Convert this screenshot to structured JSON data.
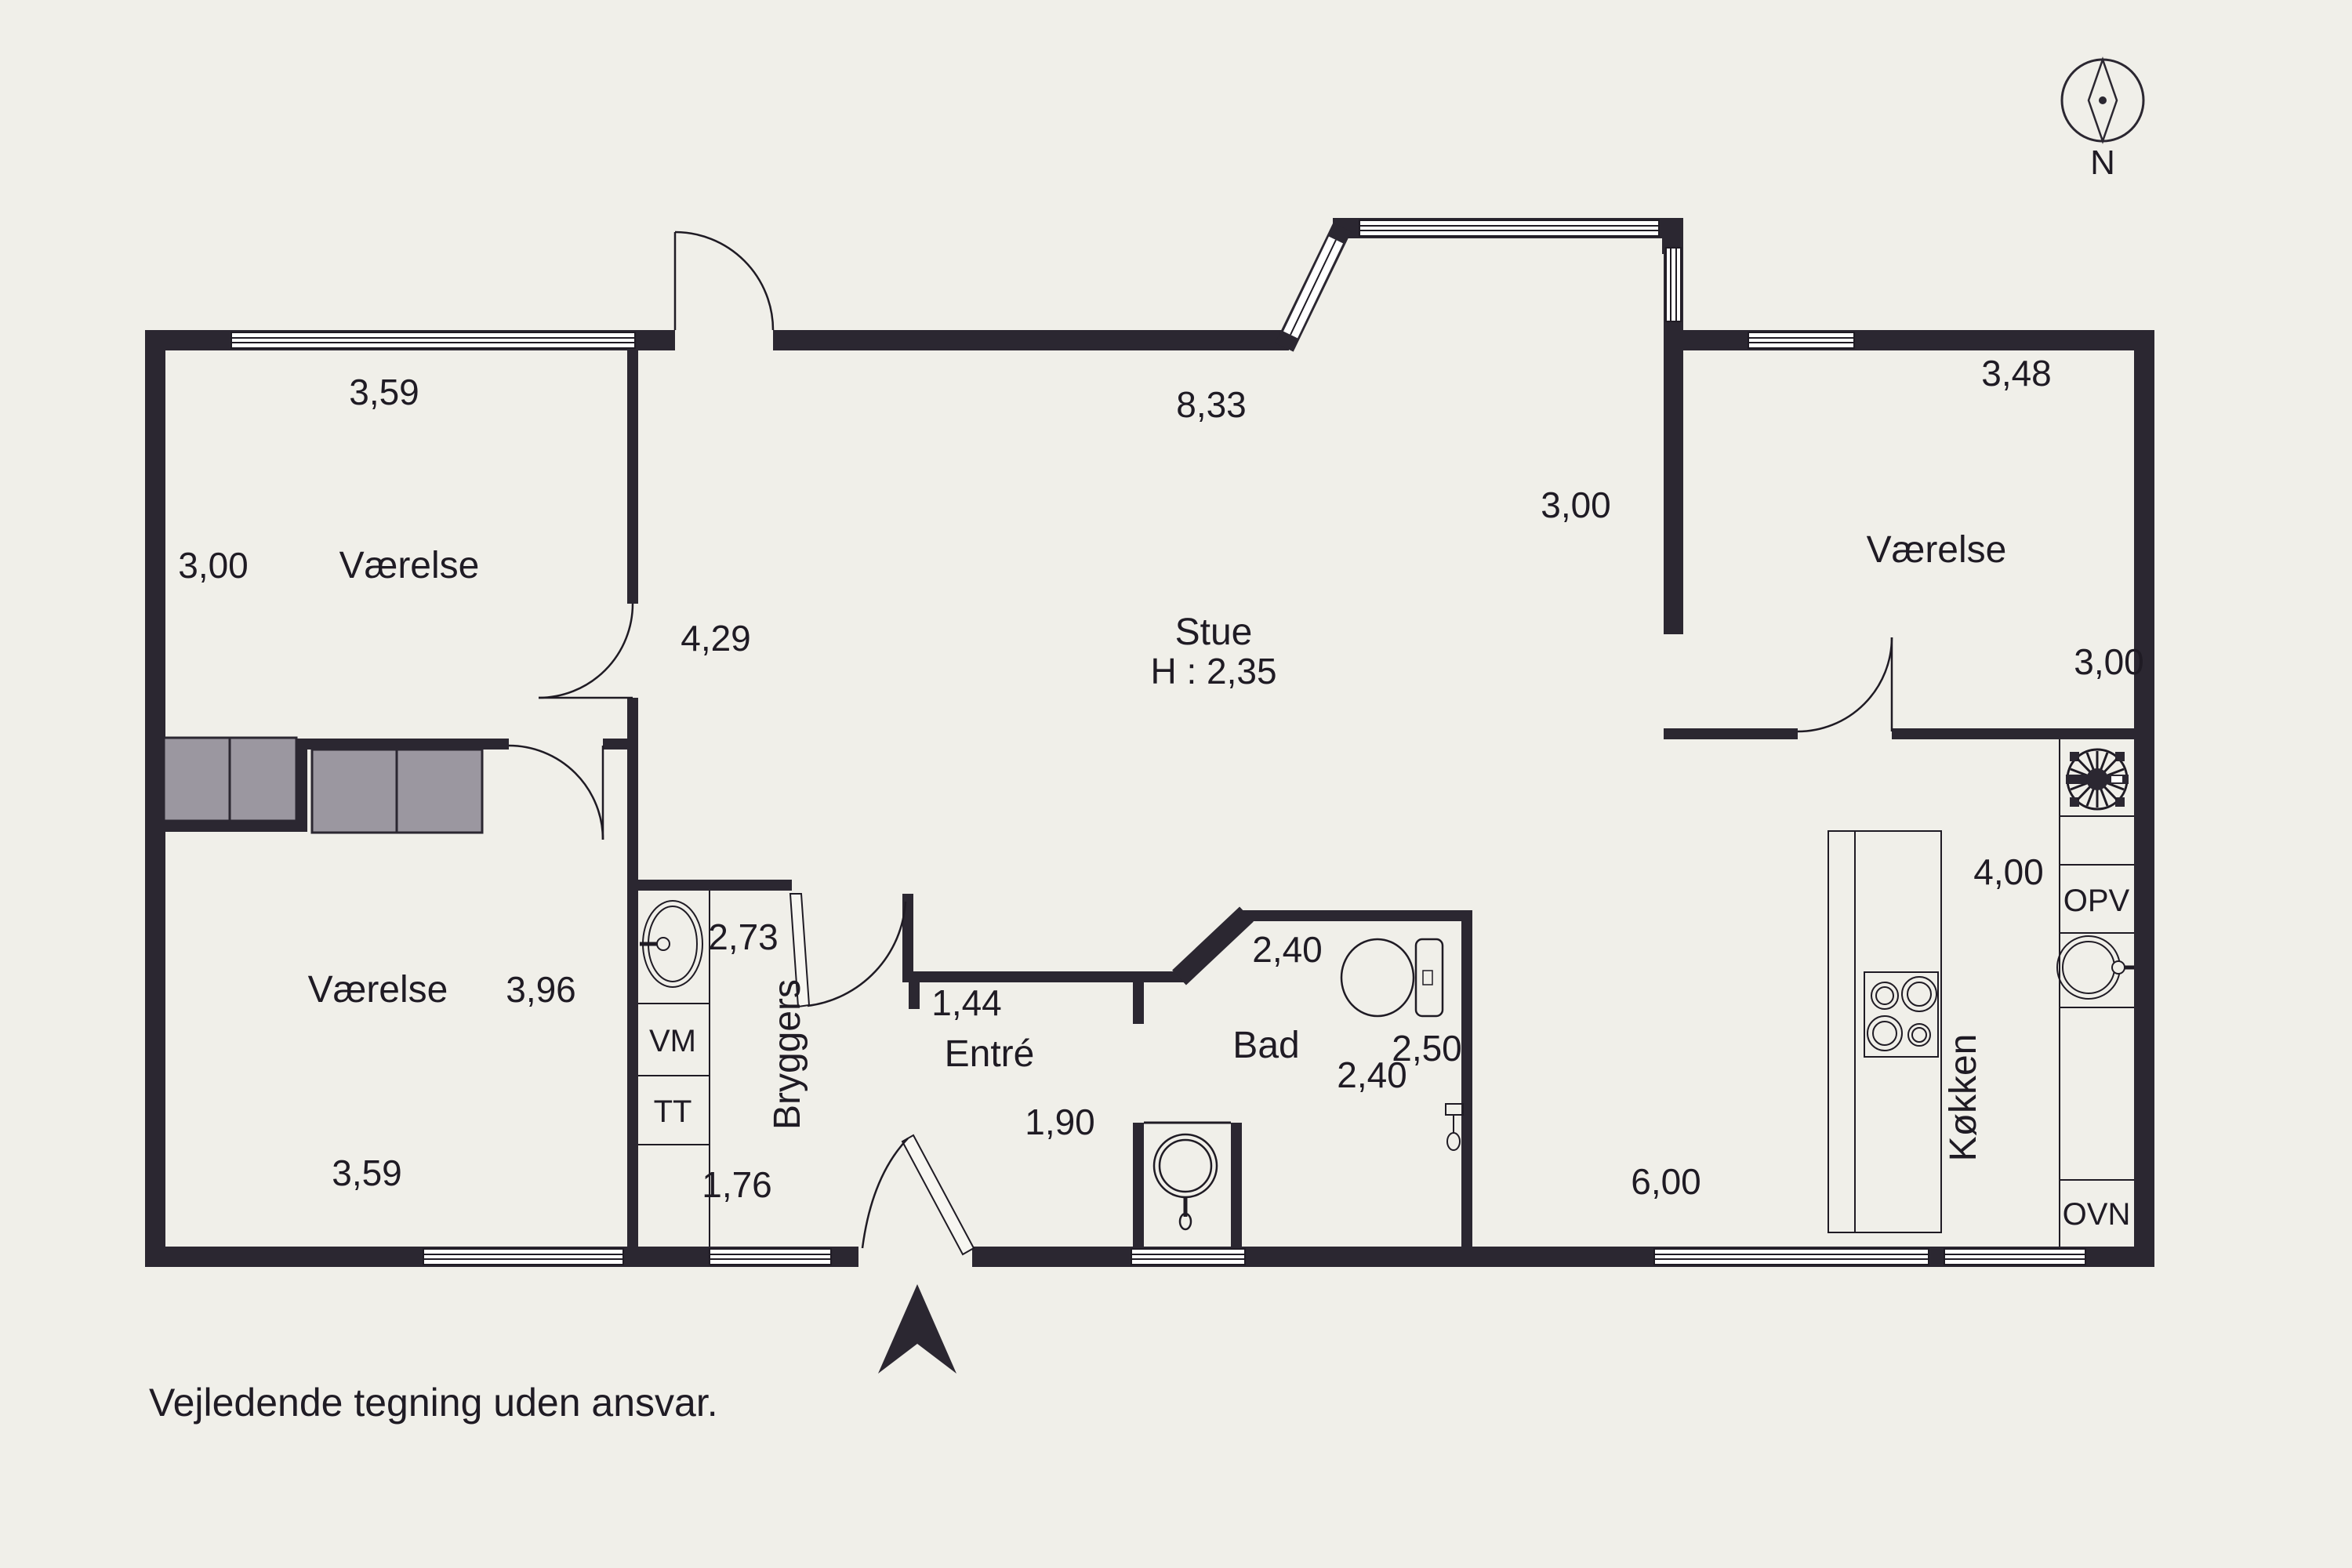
{
  "colors": {
    "background": "#f0efe9",
    "wall": "#2b2731",
    "line": "#1f1b24",
    "wardrobe": "#9b97a0",
    "window_glass": "#ffffff"
  },
  "disclaimer": "Vejledende tegning uden ansvar.",
  "compass": {
    "label": "N"
  },
  "rooms": {
    "vaerelse_top_left": {
      "name": "Værelse",
      "dim_top": "3,59",
      "dim_left": "3,00"
    },
    "stue": {
      "name": "Stue",
      "ceiling_height": "H : 2,35",
      "dim_top": "8,33",
      "dim_left": "4,29",
      "dim_bay": "3,00",
      "dim_bottom": "6,00"
    },
    "vaerelse_top_right": {
      "name": "Værelse",
      "dim_top": "3,48",
      "dim_right": "3,00"
    },
    "koekken": {
      "name": "Køkken",
      "dim": "4,00",
      "labels": {
        "opv": "OPV",
        "ovn": "OVN"
      }
    },
    "bad": {
      "name": "Bad",
      "dim_top": "2,40",
      "dim_bottom": "2,40",
      "dim_right": "2,50"
    },
    "entre": {
      "name": "Entré",
      "dim_top": "1,44",
      "dim_bottom": "1,90"
    },
    "bryggers": {
      "name": "Bryggers",
      "dim_top": "2,73",
      "dim_bottom": "1,76",
      "labels": {
        "vm": "VM",
        "tt": "TT"
      }
    },
    "vaerelse_bottom_left": {
      "name": "Værelse",
      "dim_right": "3,96",
      "dim_bottom": "3,59"
    }
  }
}
